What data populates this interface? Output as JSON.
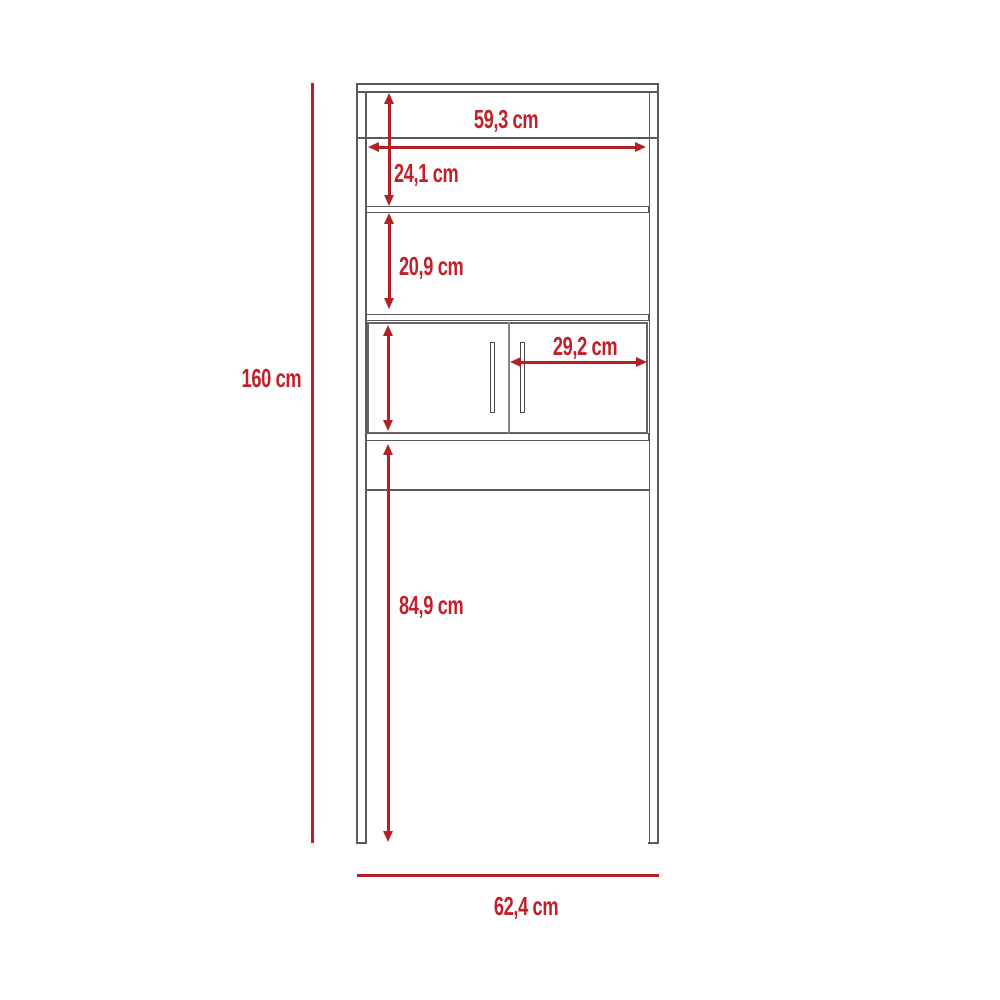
{
  "diagram": {
    "type": "furniture-dimension-diagram",
    "subject": "over-toilet-cabinet-with-two-doors",
    "unit": "cm",
    "colors": {
      "dimension_red": "#b32025",
      "label_red": "#c1202a",
      "line_gray": "#595a5c",
      "door_divider_gray": "#85878a",
      "background": "#ffffff"
    },
    "dimensions": [
      {
        "id": "total-height",
        "label": "160 cm"
      },
      {
        "id": "total-width",
        "label": "62,4 cm"
      },
      {
        "id": "shelf-inner-width",
        "label": "59,3 cm"
      },
      {
        "id": "top-section-height",
        "label": "24,1 cm"
      },
      {
        "id": "middle-section-height",
        "label": "20,9 cm"
      },
      {
        "id": "door-width",
        "label": "29,2 cm"
      },
      {
        "id": "base-clearance-height",
        "label": "84,9 cm"
      }
    ]
  }
}
